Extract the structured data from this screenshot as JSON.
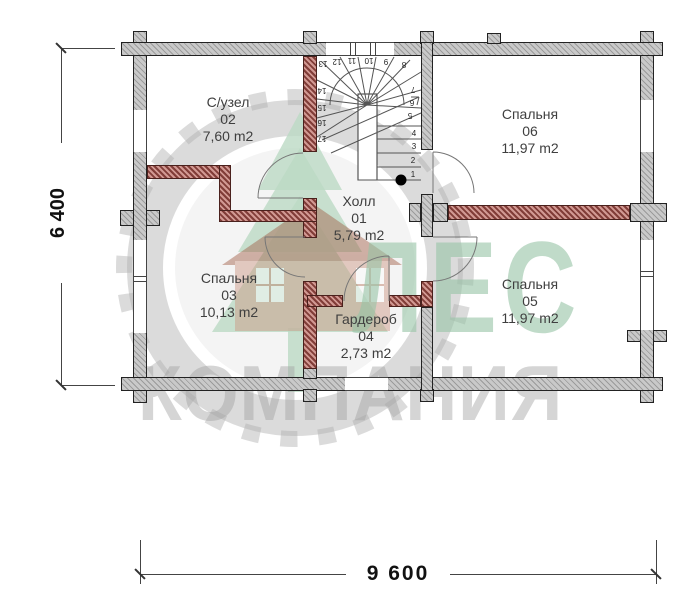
{
  "rooms": [
    {
      "name": "Холл",
      "number": "01",
      "area": "5,79 m2"
    },
    {
      "name": "С/узел",
      "number": "02",
      "area": "7,60 m2"
    },
    {
      "name": "Спальня",
      "number": "03",
      "area": "10,13 m2"
    },
    {
      "name": "Гардероб",
      "number": "04",
      "area": "2,73 m2"
    },
    {
      "name": "Спальня",
      "number": "05",
      "area": "11,97 m2"
    },
    {
      "name": "Спальня",
      "number": "06",
      "area": "11,97 m2"
    }
  ],
  "dimensions": {
    "vertical": "6 400",
    "horizontal": "9 600"
  },
  "stairs": {
    "steps": [
      "1",
      "2",
      "3",
      "4",
      "5",
      "6",
      "7",
      "8",
      "9",
      "10",
      "11",
      "12",
      "13",
      "14",
      "15",
      "16",
      "17"
    ]
  },
  "watermark": {
    "line1": "ЛЕС",
    "line2": "КОМПАНИЯ"
  },
  "colors": {
    "outer_wall": "#c9c9c9",
    "inner_wall": "#b0625c",
    "watermark_green": "#96c3a7",
    "watermark_gray": "#a2a2a2",
    "label_text": "#3f3f3f",
    "dimension_text": "#111111"
  }
}
